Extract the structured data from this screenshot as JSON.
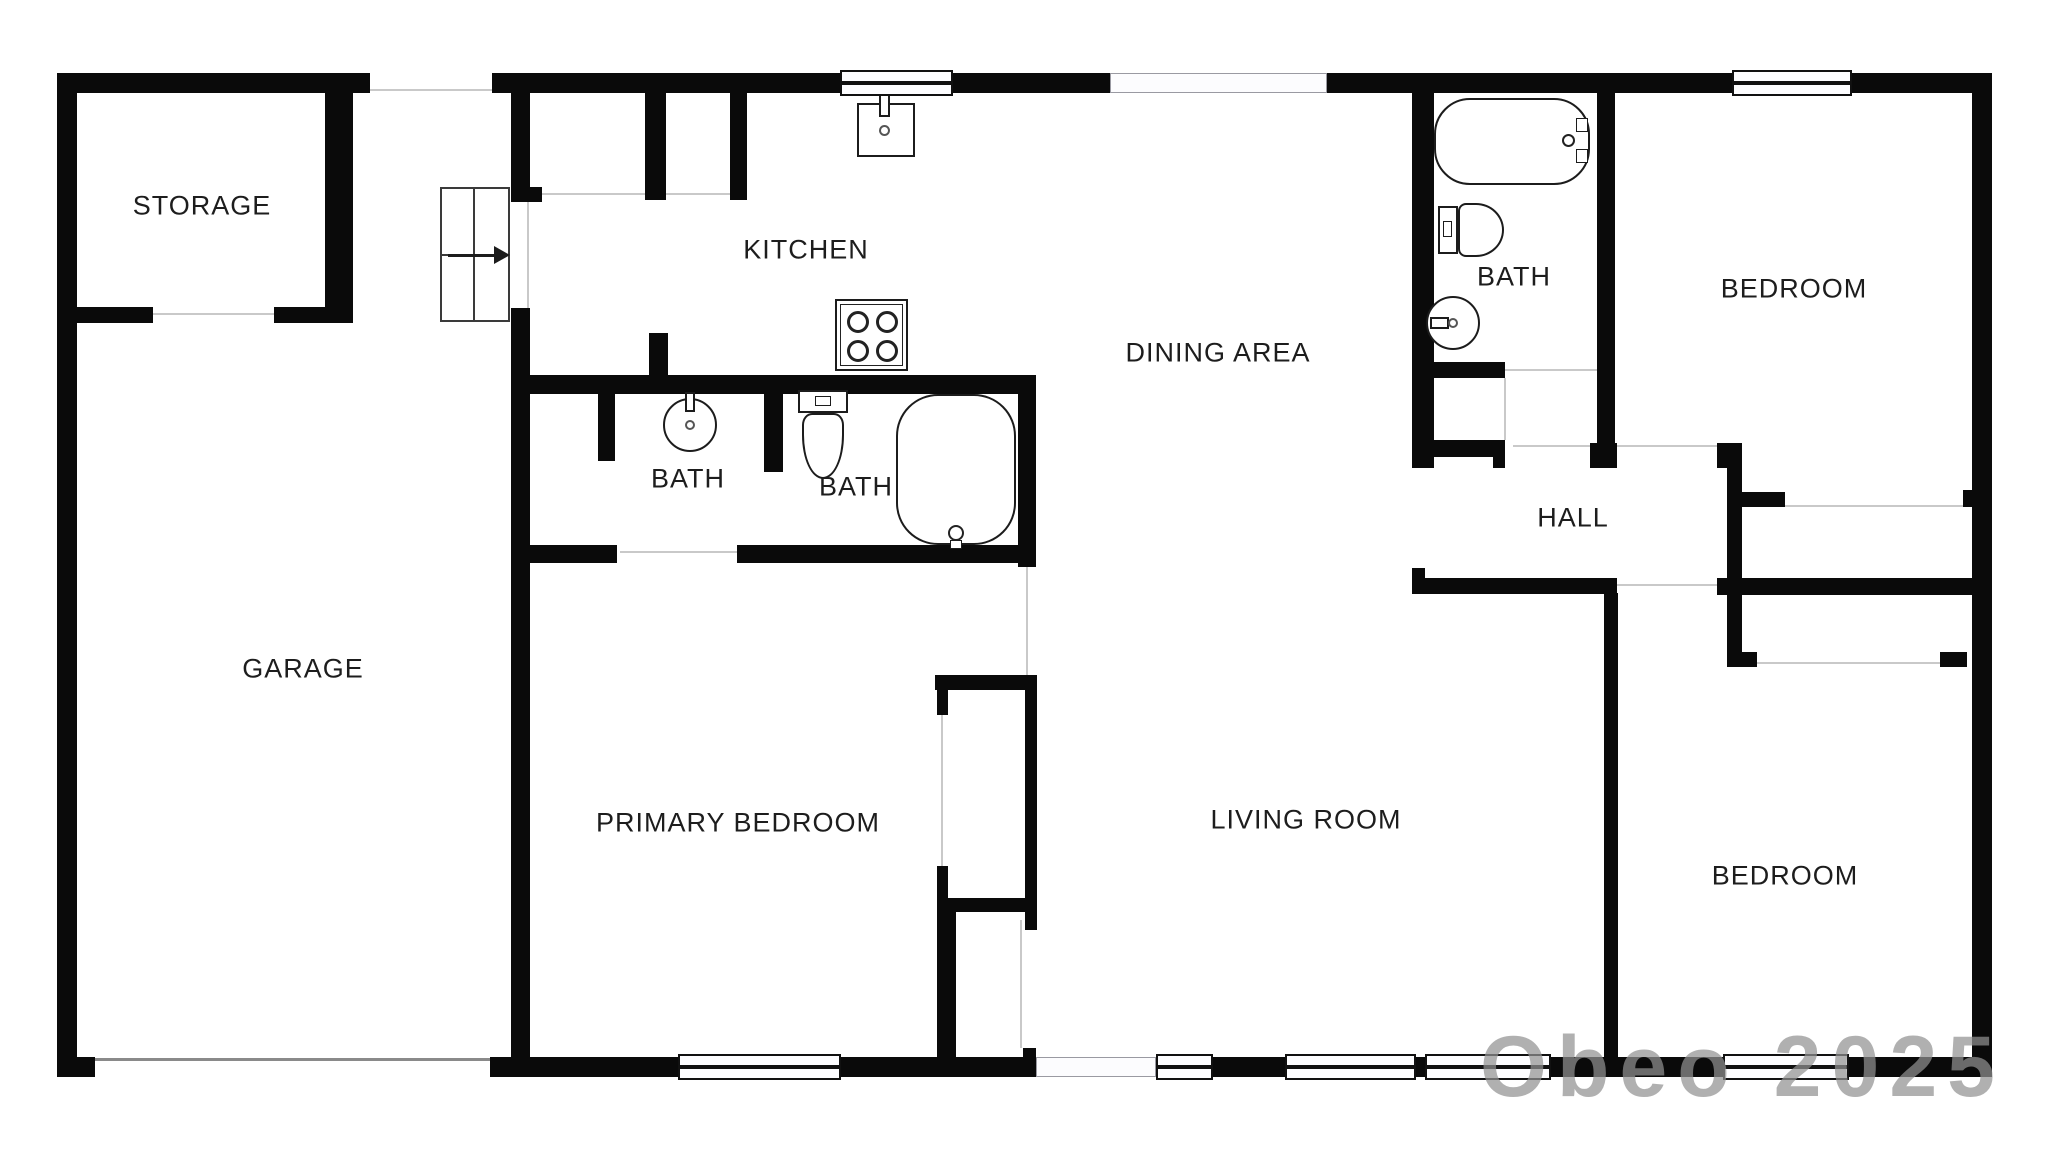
{
  "plan_title": "Single-story residential floor plan",
  "rooms": [
    {
      "id": "storage",
      "label": "STORAGE"
    },
    {
      "id": "kitchen",
      "label": "KITCHEN"
    },
    {
      "id": "dining-area",
      "label": "DINING AREA"
    },
    {
      "id": "bath-top-right",
      "label": "BATH"
    },
    {
      "id": "bedroom-top",
      "label": "BEDROOM"
    },
    {
      "id": "garage",
      "label": "GARAGE"
    },
    {
      "id": "bath-middle-1",
      "label": "BATH"
    },
    {
      "id": "bath-middle-2",
      "label": "BATH"
    },
    {
      "id": "hall",
      "label": "HALL"
    },
    {
      "id": "primary-bedroom",
      "label": "PRIMARY BEDROOM"
    },
    {
      "id": "living-room",
      "label": "LIVING ROOM"
    },
    {
      "id": "bedroom-bottom",
      "label": "BEDROOM"
    }
  ],
  "fixtures": {
    "kitchen": [
      "kitchen-sink",
      "stove-4-burner"
    ],
    "bath-middle-1": [
      "round-sink"
    ],
    "bath-middle-2": [
      "toilet",
      "bathtub"
    ],
    "bath-top-right": [
      "bathtub",
      "toilet",
      "round-sink"
    ],
    "stairs": {
      "direction": "right",
      "steps_grid": "2x2",
      "symbol": "arrow-right-icon"
    }
  },
  "openings": {
    "windows": 7,
    "sliding_doors": 2,
    "garage_door": 1,
    "door_openings": 12
  },
  "watermark": {
    "text": "Obeo 2025"
  },
  "colors": {
    "wall": "#0a0a0a",
    "background": "#ffffff",
    "label_text": "#1d1d1d",
    "door_line": "#c9c9c9",
    "watermark": "#919191"
  }
}
